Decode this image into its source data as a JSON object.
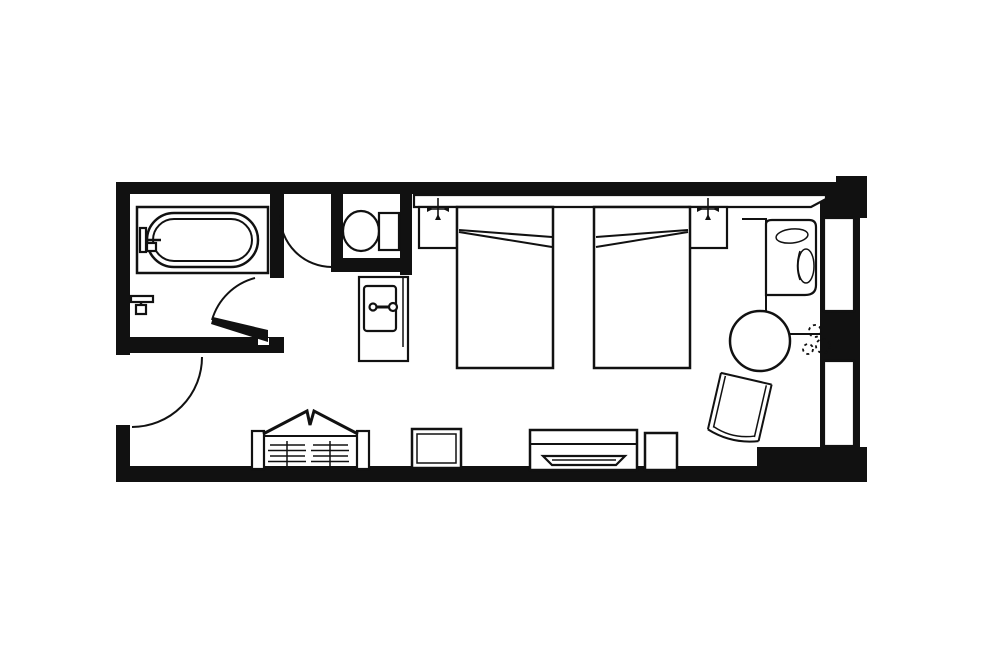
{
  "title": "hotel-guestroom-floor-plan",
  "colors": {
    "background": "#ffffff",
    "line": "#111111",
    "wall": "#111111",
    "fill": "#ffffff"
  },
  "rooms": [
    {
      "name": "bathroom"
    },
    {
      "name": "toilet-compartment"
    },
    {
      "name": "vanity-area"
    },
    {
      "name": "entry-hall"
    },
    {
      "name": "bedroom"
    }
  ],
  "fixtures": [
    "bathtub",
    "tub-faucet",
    "shower-valve",
    "toilet",
    "toilet-door",
    "bathroom-door",
    "entry-door",
    "vanity-counter",
    "vanity-sink",
    "sink-faucet",
    "headboard",
    "nightstand-left",
    "nightstand-right",
    "bed-left",
    "bed-right",
    "reading-light-left",
    "reading-light-right",
    "armchair",
    "round-side-table",
    "plant",
    "lounge-chair",
    "open-closet",
    "closet-shelves",
    "luggage-stool",
    "tv-console",
    "television",
    "mini-fridge",
    "window-upper",
    "window-lower"
  ]
}
